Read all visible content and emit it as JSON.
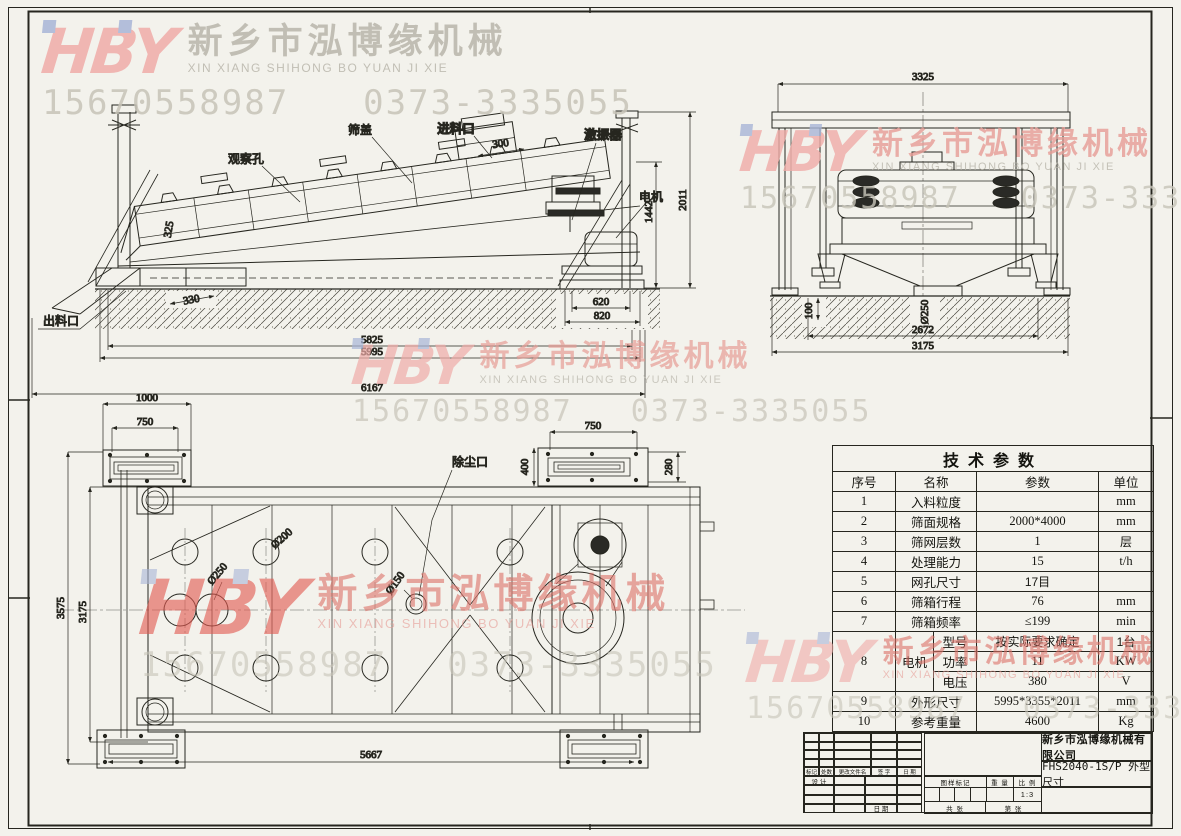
{
  "colors": {
    "paper": "#f3f2ec",
    "line": "#26261f",
    "logo_pink": "#f0aca8",
    "logo_red": "#e2574e",
    "logo_blue": "#a9b6d8",
    "wm_gray": "#b9b6ab",
    "wm_phone": "#c7c4b8",
    "wm_red": "#dd7168",
    "wm_pinkred": "#e79d96"
  },
  "watermark": {
    "logo": "HBY",
    "company_cn": "新乡市泓博缘机械",
    "company_en": "XIN XIANG SHIHONG BO YUAN JI XIE",
    "phone1": "15670558987",
    "phone2": "0373-3335055"
  },
  "views": {
    "side": {
      "labels": {
        "observation_hole": "观察孔",
        "screen_cover": "筛盖",
        "feed_inlet": "进料口",
        "exciter": "激振器",
        "motor": "电机",
        "discharge_outlet": "出料口"
      },
      "dims": {
        "d300": "300",
        "d2011": "2011",
        "d1442": "1442",
        "d325": "325",
        "d330": "330",
        "d620": "620",
        "d820": "820",
        "d5825": "5825",
        "d5995": "5995",
        "d6167": "6167"
      }
    },
    "end": {
      "dims": {
        "d3325": "3325",
        "d250": "Ø250",
        "d100": "100",
        "d2672": "2672",
        "d3175": "3175"
      }
    },
    "plan": {
      "labels": {
        "dust_port": "除尘口"
      },
      "dims": {
        "d1000": "1000",
        "d750L": "750",
        "d750R": "750",
        "d400": "400",
        "d280": "280",
        "d200": "Ø200",
        "d250": "Ø250",
        "d150": "Ø150",
        "d3575": "3575",
        "d3175": "3175",
        "d5667": "5667"
      }
    }
  },
  "table": {
    "title": "技术参数",
    "headers": [
      "序号",
      "名称",
      "参数",
      "单位"
    ],
    "rows": [
      {
        "no": "1",
        "name": "入料粒度",
        "value": "",
        "unit": "mm"
      },
      {
        "no": "2",
        "name": "筛面规格",
        "value": "2000*4000",
        "unit": "mm"
      },
      {
        "no": "3",
        "name": "筛网层数",
        "value": "1",
        "unit": "层"
      },
      {
        "no": "4",
        "name": "处理能力",
        "value": "15",
        "unit": "t/h"
      },
      {
        "no": "5",
        "name": "网孔尺寸",
        "value": "17目",
        "unit": ""
      },
      {
        "no": "6",
        "name": "筛箱行程",
        "value": "76",
        "unit": "mm"
      },
      {
        "no": "7",
        "name": "筛箱频率",
        "value": "≤199",
        "unit": "min"
      }
    ],
    "motor_row": {
      "no": "8",
      "name": "电机",
      "subs": [
        {
          "label": "型号",
          "value": "按实际要求确定",
          "unit": "1台"
        },
        {
          "label": "功率",
          "value": "11",
          "unit": "KW"
        },
        {
          "label": "电压",
          "value": "380",
          "unit": "V"
        }
      ]
    },
    "row9": {
      "no": "9",
      "name": "外形尺寸",
      "value": "5995*3355*2011",
      "unit": "mm"
    },
    "row10": {
      "no": "10",
      "name": "参考重量",
      "value": "4600",
      "unit": "Kg"
    }
  },
  "title_block": {
    "company": "新乡市泓博缘机械有限公司",
    "drawing_title": "FHS2040-1S/P  外型尺寸",
    "rev_labels": [
      "标记",
      "处数",
      "更改文件名",
      "签 字",
      "日 期"
    ],
    "design_label": "设 计",
    "date_label": "日 期",
    "mark_label": "图样标记",
    "weight_label": "重 量",
    "scale_label": "比 例",
    "scale_value": "1:3",
    "sheets_label": "共  张",
    "sheet_label": "第  张"
  }
}
